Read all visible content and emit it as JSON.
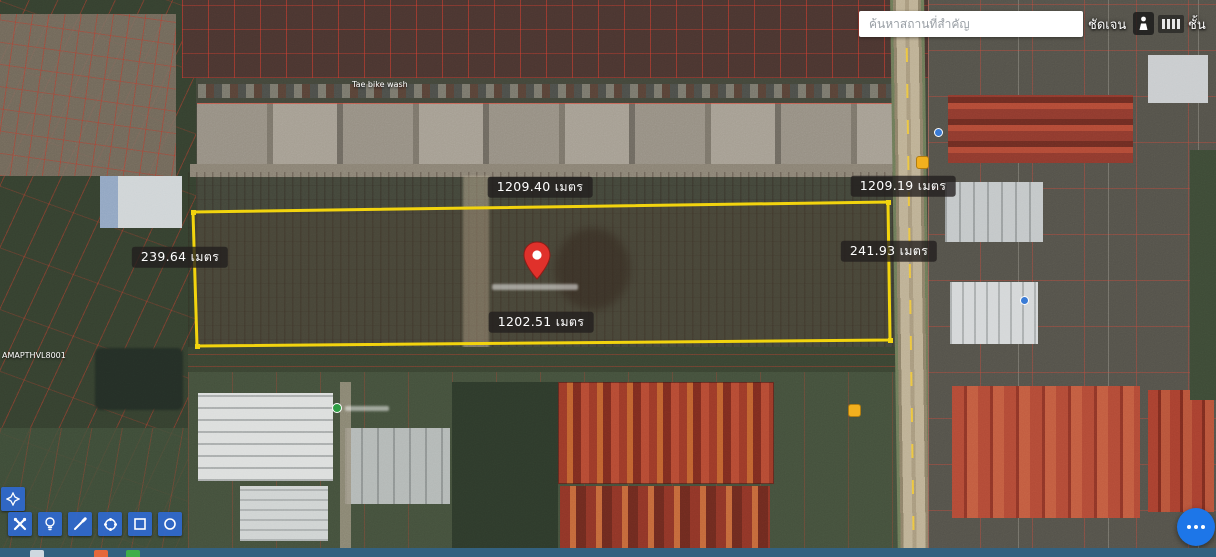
{
  "search": {
    "placeholder": "ค้นหาสถานที่สำคัญ"
  },
  "topbar": {
    "clear_label": "ชัดเจน",
    "layer_label": "ชั้น",
    "icons": [
      "street-view-person-icon",
      "bars-icon"
    ]
  },
  "measurements": {
    "top": "1209.40 เมตร",
    "top_right": "1209.19 เมตร",
    "left": "239.64 เมตร",
    "right": "241.93 เมตร",
    "bottom": "1202.51 เมตร"
  },
  "map_labels": {
    "bike_wash": "Tae bike wash",
    "left_code": "AMAPTHVL8001"
  },
  "toolbar": {
    "buttons": [
      {
        "icon": "tools-icon"
      },
      {
        "icon": "bulb-icon"
      },
      {
        "icon": "pencil-icon"
      },
      {
        "icon": "polygon-icon"
      },
      {
        "icon": "rectangle-icon"
      },
      {
        "icon": "circle-icon"
      }
    ],
    "pan_button_icon": "pan-hand-icon"
  },
  "fab": {
    "icon": "more-options-icon"
  },
  "marker": {
    "icon": "red-map-pin"
  },
  "colors": {
    "parcel_outline": "#f2d40e",
    "toolbar_blue": "#2f69d0",
    "fab_blue": "#1d76e8",
    "pin_red": "#e0312b",
    "cadastral_red": "#e0392e"
  }
}
